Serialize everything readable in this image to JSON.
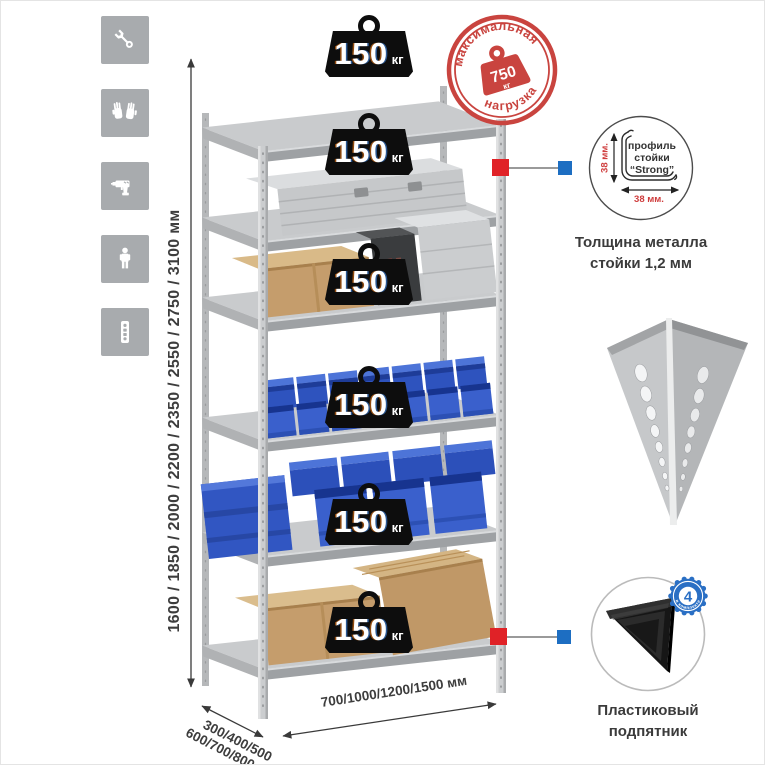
{
  "canvas": {
    "width": 765,
    "height": 765,
    "background": "#ffffff"
  },
  "left_icon_strip": {
    "bg_color": "#a8abae",
    "icons": [
      "wrench-icon",
      "gloves-icon",
      "drill-icon",
      "person-icon",
      "post-profile-icon"
    ]
  },
  "dimension_labels": {
    "height": "1600 / 1850 / 2000 / 2200 / 2350 / 2550 / 2750 / 3100 мм",
    "depth_line1": "300/400/500",
    "depth_line2": "600/700/800 мм",
    "width": "700/1000/1200/1500 мм"
  },
  "shelf_load": {
    "value": "150",
    "unit": "кг",
    "badge_count": 6,
    "icon": "weight-icon"
  },
  "max_load_stamp": {
    "arc_top": "максимальная",
    "arc_bottom": "нагрузка",
    "value": "750",
    "unit": "кг",
    "color": "#c9443f",
    "icon": "weight-icon"
  },
  "profile_callout": {
    "line1": "профиль",
    "line2": "стойки",
    "line3": "“Strong”",
    "vertical_dim": "38 мм.",
    "horizontal_dim": "38 мм.",
    "caption_line1": "Толщина металла",
    "caption_line2": "стойки 1,2 мм"
  },
  "foot_callout": {
    "badge_number": "4",
    "badge_arc_text": "в комплекте",
    "caption_line1": "Пластиковый",
    "caption_line2": "подпятник"
  },
  "connector_markers": {
    "red": "#e02227",
    "blue": "#1d6ec2"
  },
  "palette": {
    "metal": "#c6c8ca",
    "bin_blue": "#3358c5",
    "cardboard": "#c59d6c",
    "weight_black": "#0d0d0d"
  }
}
